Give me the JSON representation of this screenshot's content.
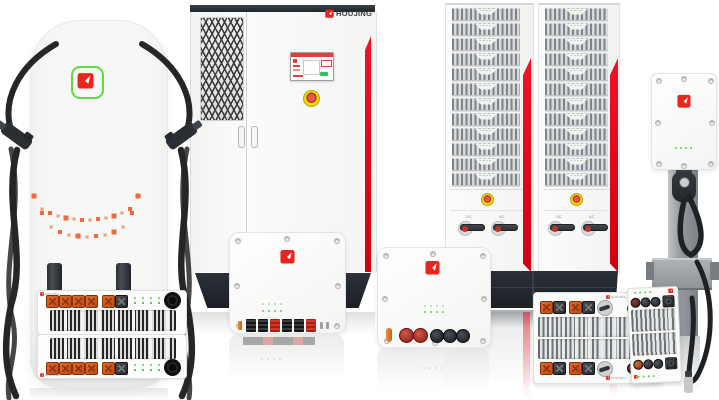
{
  "brand": {
    "name": "HOUJING",
    "logo_icon": "white-arrow-in-red-square"
  },
  "colors": {
    "brand_red": "#e8251f",
    "stripe_red": "#e60113",
    "logo_green": "#63d94a",
    "connector_orange": "#d9541c",
    "led_green": "#57c84f",
    "estop_yellow": "#f2d600",
    "estop_red": "#c94030",
    "dark_base": "#23272e",
    "cable_black": "#232323",
    "indicator_dot_orange": "#ef6b3c"
  },
  "power_cabinet": {
    "brand_label": "HOUJING"
  },
  "rack_system": {
    "vertical_label": "厚景HOUJING",
    "columns": 2,
    "modules_per_column": 12,
    "breaker_labels": [
      "DC",
      "AC"
    ]
  }
}
